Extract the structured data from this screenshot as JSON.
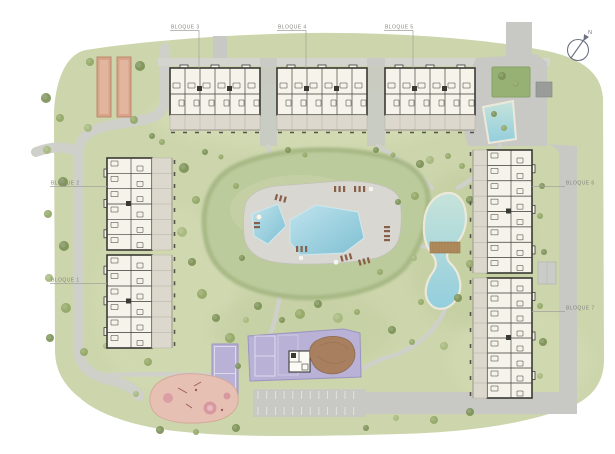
{
  "labels": {
    "bloque1": {
      "text": "BLOQUE 1"
    },
    "bloque2": {
      "text": "BLOQUE 2"
    },
    "bloque3": {
      "text": "BLOQUE 3"
    },
    "bloque4": {
      "text": "BLOQUE 4"
    },
    "bloque5": {
      "text": "BLOQUE 5"
    },
    "bloque6": {
      "text": "BLOQUE 6"
    },
    "bloque7": {
      "text": "BLOQUE 7"
    }
  },
  "north_arrow": {
    "letter": "N"
  },
  "colors": {
    "page-bg": "#ffffff",
    "lawn": "#ccd5ab",
    "lawn-light": "#d7dfba",
    "lawn-dark": "#bcc999",
    "mound": "#bccb9b",
    "mound-edge": "#a6b884",
    "road": "#c8c9c4",
    "path": "#cfd0ca",
    "sidewalk": "#d5d5d0",
    "deck": "#d8d7d1",
    "pool-blue": "#7fc0d4",
    "pool-light": "#bfe3ec",
    "pond-top": "#c6e3da",
    "pond-bottom": "#93cedd",
    "pond-edge": "#ece9da",
    "court-purple": "#b9b2d6",
    "court-line": "#e6e4f2",
    "terracotta": "#d8a388",
    "terracotta-dark": "#bd8a6e",
    "playground-pink": "#e6c1b3",
    "playground-dark": "#d898a0",
    "bridge-brown": "#b08a5d",
    "mound-brown": "#a8805f",
    "lounger-brown": "#8a5f49",
    "building-fill": "#f6f3ea",
    "building-stroke": "#3a3a35",
    "terrace": "#dcd8cd",
    "tree-dark": "#7c9156",
    "tree-mid": "#92a766",
    "tree-light": "#a6b97d",
    "label-gray": "#85847f",
    "compass-gray": "#6b7280"
  }
}
